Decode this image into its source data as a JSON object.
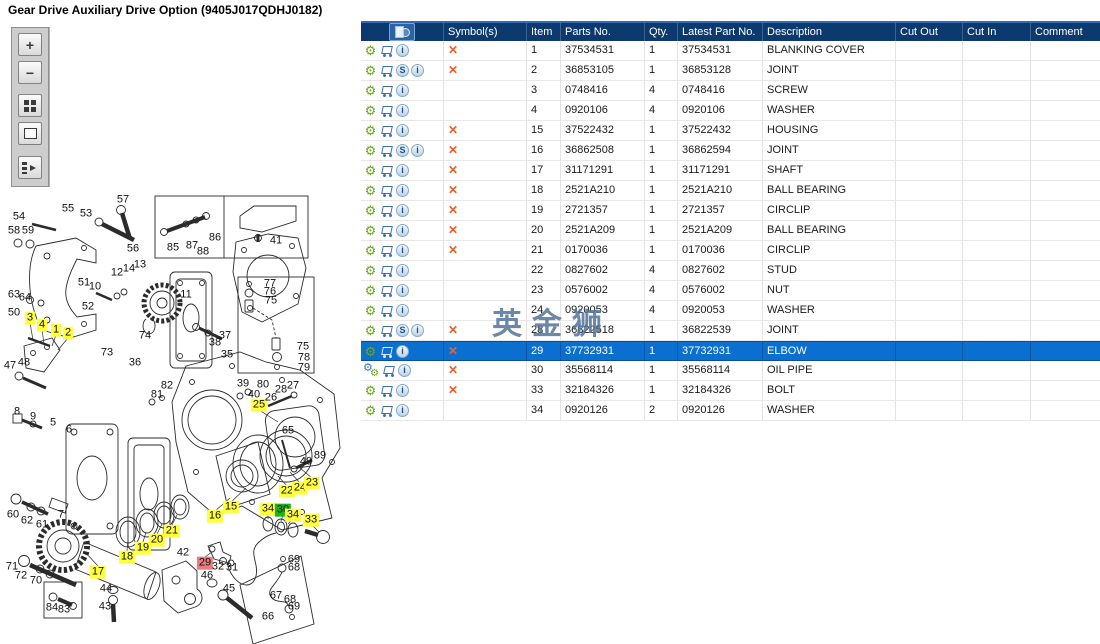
{
  "title": "Gear Drive Auxiliary Drive Option (9405J017QDHJ0182)",
  "watermark": "英金狮",
  "colors": {
    "header_bg": "#0D3A6E",
    "header_text": "#FFFFFF",
    "selected_bg": "#0B6FD0",
    "selected_text": "#FFFFFF",
    "grid_line": "#E3E3E3",
    "cross": "#E8622D",
    "gear_green": "#67A81C",
    "cart_blue": "#3D6EB5",
    "hl_yellow": "#FFFF3F",
    "hl_green": "#1DB31D",
    "hl_red": "#E97C7C",
    "watermark": "#53749B"
  },
  "icons": {
    "gear_glyph": "⚙",
    "cross_glyph": "✕",
    "s_glyph": "S",
    "info_glyph": "i"
  },
  "toolbar": {
    "buttons": [
      {
        "name": "zoom-in",
        "glyph": "+"
      },
      {
        "name": "zoom-out",
        "glyph": "−"
      },
      {
        "name": "tile-view",
        "glyph": ""
      },
      {
        "name": "fit-view",
        "glyph": ""
      },
      {
        "name": "export-panel",
        "glyph": ""
      }
    ]
  },
  "table": {
    "columns": [
      {
        "key": "tools",
        "label": ""
      },
      {
        "key": "symbols",
        "label": "Symbol(s)"
      },
      {
        "key": "item",
        "label": "Item"
      },
      {
        "key": "parts_no",
        "label": "Parts No."
      },
      {
        "key": "qty",
        "label": "Qty."
      },
      {
        "key": "latest_part_no",
        "label": "Latest Part No."
      },
      {
        "key": "description",
        "label": "Description"
      },
      {
        "key": "cut_out",
        "label": "Cut Out"
      },
      {
        "key": "cut_in",
        "label": "Cut In"
      },
      {
        "key": "comment",
        "label": "Comment"
      }
    ],
    "rows": [
      {
        "item": "1",
        "parts_no": "37534531",
        "qty": "1",
        "latest_part_no": "37534531",
        "description": "BLANKING COVER",
        "symbol": true,
        "icons": [
          "gear",
          "cart",
          "info"
        ],
        "selected": false,
        "cut_out": "",
        "cut_in": "",
        "comment": ""
      },
      {
        "item": "2",
        "parts_no": "36853105",
        "qty": "1",
        "latest_part_no": "36853128",
        "description": "JOINT",
        "symbol": true,
        "icons": [
          "gear",
          "cart",
          "s",
          "info"
        ],
        "selected": false,
        "cut_out": "",
        "cut_in": "",
        "comment": ""
      },
      {
        "item": "3",
        "parts_no": "0748416",
        "qty": "4",
        "latest_part_no": "0748416",
        "description": "SCREW",
        "symbol": false,
        "icons": [
          "gear",
          "cart",
          "info"
        ],
        "selected": false,
        "cut_out": "",
        "cut_in": "",
        "comment": ""
      },
      {
        "item": "4",
        "parts_no": "0920106",
        "qty": "4",
        "latest_part_no": "0920106",
        "description": "WASHER",
        "symbol": false,
        "icons": [
          "gear",
          "cart",
          "info"
        ],
        "selected": false,
        "cut_out": "",
        "cut_in": "",
        "comment": ""
      },
      {
        "item": "15",
        "parts_no": "37522432",
        "qty": "1",
        "latest_part_no": "37522432",
        "description": "HOUSING",
        "symbol": true,
        "icons": [
          "gear",
          "cart",
          "info"
        ],
        "selected": false,
        "cut_out": "",
        "cut_in": "",
        "comment": ""
      },
      {
        "item": "16",
        "parts_no": "36862508",
        "qty": "1",
        "latest_part_no": "36862594",
        "description": "JOINT",
        "symbol": true,
        "icons": [
          "gear",
          "cart",
          "s",
          "info"
        ],
        "selected": false,
        "cut_out": "",
        "cut_in": "",
        "comment": ""
      },
      {
        "item": "17",
        "parts_no": "31171291",
        "qty": "1",
        "latest_part_no": "31171291",
        "description": "SHAFT",
        "symbol": true,
        "icons": [
          "gear",
          "cart",
          "info"
        ],
        "selected": false,
        "cut_out": "",
        "cut_in": "",
        "comment": ""
      },
      {
        "item": "18",
        "parts_no": "2521A210",
        "qty": "1",
        "latest_part_no": "2521A210",
        "description": "BALL BEARING",
        "symbol": true,
        "icons": [
          "gear",
          "cart",
          "info"
        ],
        "selected": false,
        "cut_out": "",
        "cut_in": "",
        "comment": ""
      },
      {
        "item": "19",
        "parts_no": "2721357",
        "qty": "1",
        "latest_part_no": "2721357",
        "description": "CIRCLIP",
        "symbol": true,
        "icons": [
          "gear",
          "cart",
          "info"
        ],
        "selected": false,
        "cut_out": "",
        "cut_in": "",
        "comment": ""
      },
      {
        "item": "20",
        "parts_no": "2521A209",
        "qty": "1",
        "latest_part_no": "2521A209",
        "description": "BALL BEARING",
        "symbol": true,
        "icons": [
          "gear",
          "cart",
          "info"
        ],
        "selected": false,
        "cut_out": "",
        "cut_in": "",
        "comment": ""
      },
      {
        "item": "21",
        "parts_no": "0170036",
        "qty": "1",
        "latest_part_no": "0170036",
        "description": "CIRCLIP",
        "symbol": true,
        "icons": [
          "gear",
          "cart",
          "info"
        ],
        "selected": false,
        "cut_out": "",
        "cut_in": "",
        "comment": ""
      },
      {
        "item": "22",
        "parts_no": "0827602",
        "qty": "4",
        "latest_part_no": "0827602",
        "description": "STUD",
        "symbol": false,
        "icons": [
          "gear",
          "cart",
          "info"
        ],
        "selected": false,
        "cut_out": "",
        "cut_in": "",
        "comment": ""
      },
      {
        "item": "23",
        "parts_no": "0576002",
        "qty": "4",
        "latest_part_no": "0576002",
        "description": "NUT",
        "symbol": false,
        "icons": [
          "gear",
          "cart",
          "info"
        ],
        "selected": false,
        "cut_out": "",
        "cut_in": "",
        "comment": ""
      },
      {
        "item": "24",
        "parts_no": "0920053",
        "qty": "4",
        "latest_part_no": "0920053",
        "description": "WASHER",
        "symbol": false,
        "icons": [
          "gear",
          "cart",
          "info"
        ],
        "selected": false,
        "cut_out": "",
        "cut_in": "",
        "comment": ""
      },
      {
        "item": "28",
        "parts_no": "36822518",
        "qty": "1",
        "latest_part_no": "36822539",
        "description": "JOINT",
        "symbol": true,
        "icons": [
          "gear",
          "cart",
          "s",
          "info"
        ],
        "selected": false,
        "cut_out": "",
        "cut_in": "",
        "comment": ""
      },
      {
        "item": "29",
        "parts_no": "37732931",
        "qty": "1",
        "latest_part_no": "37732931",
        "description": "ELBOW",
        "symbol": true,
        "icons": [
          "gear",
          "cart",
          "info"
        ],
        "selected": true,
        "cut_out": "",
        "cut_in": "",
        "comment": ""
      },
      {
        "item": "30",
        "parts_no": "35568114",
        "qty": "1",
        "latest_part_no": "35568114",
        "description": "OIL PIPE",
        "symbol": true,
        "icons": [
          "gear-double",
          "cart",
          "info"
        ],
        "selected": false,
        "cut_out": "",
        "cut_in": "",
        "comment": ""
      },
      {
        "item": "33",
        "parts_no": "32184326",
        "qty": "1",
        "latest_part_no": "32184326",
        "description": "BOLT",
        "symbol": true,
        "icons": [
          "gear",
          "cart",
          "info"
        ],
        "selected": false,
        "cut_out": "",
        "cut_in": "",
        "comment": ""
      },
      {
        "item": "34",
        "parts_no": "0920126",
        "qty": "2",
        "latest_part_no": "0920126",
        "description": "WASHER",
        "symbol": false,
        "icons": [
          "gear",
          "cart",
          "info"
        ],
        "selected": false,
        "cut_out": "",
        "cut_in": "",
        "comment": ""
      }
    ]
  },
  "diagram": {
    "labels": [
      {
        "n": "54",
        "x": 19,
        "y": 217
      },
      {
        "n": "55",
        "x": 68,
        "y": 209
      },
      {
        "n": "53",
        "x": 86,
        "y": 214
      },
      {
        "n": "57",
        "x": 123,
        "y": 200
      },
      {
        "n": "58",
        "x": 14,
        "y": 231
      },
      {
        "n": "59",
        "x": 28,
        "y": 231
      },
      {
        "n": "56",
        "x": 133,
        "y": 249
      },
      {
        "n": "85",
        "x": 173,
        "y": 248
      },
      {
        "n": "87",
        "x": 192,
        "y": 246
      },
      {
        "n": "88",
        "x": 203,
        "y": 252
      },
      {
        "n": "86",
        "x": 215,
        "y": 238
      },
      {
        "n": "41",
        "x": 276,
        "y": 241
      },
      {
        "n": "12",
        "x": 117,
        "y": 273
      },
      {
        "n": "14",
        "x": 129,
        "y": 269
      },
      {
        "n": "13",
        "x": 140,
        "y": 265
      },
      {
        "n": "63",
        "x": 14,
        "y": 295
      },
      {
        "n": "64",
        "x": 25,
        "y": 298
      },
      {
        "n": "50",
        "x": 14,
        "y": 313
      },
      {
        "n": "51",
        "x": 84,
        "y": 283
      },
      {
        "n": "10",
        "x": 95,
        "y": 287
      },
      {
        "n": "52",
        "x": 88,
        "y": 307
      },
      {
        "n": "11",
        "x": 186,
        "y": 295
      },
      {
        "n": "74",
        "x": 145,
        "y": 336
      },
      {
        "n": "3",
        "x": 30,
        "y": 318,
        "h": "y"
      },
      {
        "n": "4",
        "x": 42,
        "y": 325,
        "h": "y"
      },
      {
        "n": "1",
        "x": 56,
        "y": 330,
        "h": "y"
      },
      {
        "n": "2",
        "x": 68,
        "y": 333,
        "h": "y"
      },
      {
        "n": "37",
        "x": 225,
        "y": 336
      },
      {
        "n": "38",
        "x": 215,
        "y": 343
      },
      {
        "n": "35",
        "x": 227,
        "y": 355
      },
      {
        "n": "73",
        "x": 107,
        "y": 353
      },
      {
        "n": "36",
        "x": 135,
        "y": 363
      },
      {
        "n": "47",
        "x": 10,
        "y": 366
      },
      {
        "n": "48",
        "x": 24,
        "y": 363
      },
      {
        "n": "77",
        "x": 270,
        "y": 284
      },
      {
        "n": "76",
        "x": 270,
        "y": 292
      },
      {
        "n": "75",
        "x": 271,
        "y": 301
      },
      {
        "n": "75",
        "x": 303,
        "y": 347
      },
      {
        "n": "78",
        "x": 304,
        "y": 358
      },
      {
        "n": "79",
        "x": 304,
        "y": 368
      },
      {
        "n": "82",
        "x": 167,
        "y": 386
      },
      {
        "n": "81",
        "x": 157,
        "y": 395
      },
      {
        "n": "39",
        "x": 243,
        "y": 384
      },
      {
        "n": "80",
        "x": 263,
        "y": 385
      },
      {
        "n": "40",
        "x": 254,
        "y": 395
      },
      {
        "n": "25",
        "x": 259,
        "y": 405,
        "h": "y"
      },
      {
        "n": "26",
        "x": 271,
        "y": 398
      },
      {
        "n": "28",
        "x": 281,
        "y": 390
      },
      {
        "n": "27",
        "x": 293,
        "y": 386
      },
      {
        "n": "65",
        "x": 288,
        "y": 431
      },
      {
        "n": "8",
        "x": 17,
        "y": 412
      },
      {
        "n": "9",
        "x": 33,
        "y": 417
      },
      {
        "n": "5",
        "x": 53,
        "y": 423
      },
      {
        "n": "6",
        "x": 69,
        "y": 430
      },
      {
        "n": "60",
        "x": 13,
        "y": 515
      },
      {
        "n": "62",
        "x": 27,
        "y": 521
      },
      {
        "n": "61",
        "x": 42,
        "y": 525
      },
      {
        "n": "7",
        "x": 61,
        "y": 515
      },
      {
        "n": "71",
        "x": 12,
        "y": 567
      },
      {
        "n": "72",
        "x": 21,
        "y": 576
      },
      {
        "n": "70",
        "x": 36,
        "y": 581
      },
      {
        "n": "84",
        "x": 52,
        "y": 608
      },
      {
        "n": "83",
        "x": 64,
        "y": 610
      },
      {
        "n": "17",
        "x": 98,
        "y": 572,
        "h": "y"
      },
      {
        "n": "18",
        "x": 127,
        "y": 557,
        "h": "y"
      },
      {
        "n": "19",
        "x": 143,
        "y": 548,
        "h": "y"
      },
      {
        "n": "20",
        "x": 157,
        "y": 540,
        "h": "y"
      },
      {
        "n": "21",
        "x": 172,
        "y": 531,
        "h": "y"
      },
      {
        "n": "42",
        "x": 183,
        "y": 553
      },
      {
        "n": "44",
        "x": 106,
        "y": 589
      },
      {
        "n": "43",
        "x": 105,
        "y": 607
      },
      {
        "n": "49",
        "x": 306,
        "y": 462
      },
      {
        "n": "89",
        "x": 320,
        "y": 456
      },
      {
        "n": "22",
        "x": 287,
        "y": 491,
        "h": "y"
      },
      {
        "n": "24",
        "x": 300,
        "y": 488,
        "h": "y"
      },
      {
        "n": "23",
        "x": 312,
        "y": 483,
        "h": "y"
      },
      {
        "n": "15",
        "x": 231,
        "y": 507,
        "h": "y"
      },
      {
        "n": "16",
        "x": 215,
        "y": 516,
        "h": "y"
      },
      {
        "n": "34",
        "x": 268,
        "y": 509,
        "h": "y"
      },
      {
        "n": "30",
        "x": 283,
        "y": 510,
        "h": "g"
      },
      {
        "n": "34",
        "x": 293,
        "y": 515,
        "h": "y"
      },
      {
        "n": "33",
        "x": 311,
        "y": 520,
        "h": "y"
      },
      {
        "n": "29",
        "x": 205,
        "y": 563,
        "h": "r"
      },
      {
        "n": "32",
        "x": 218,
        "y": 567
      },
      {
        "n": "31",
        "x": 232,
        "y": 568
      },
      {
        "n": "46",
        "x": 207,
        "y": 576
      },
      {
        "n": "45",
        "x": 229,
        "y": 589
      },
      {
        "n": "69",
        "x": 294,
        "y": 560
      },
      {
        "n": "68",
        "x": 294,
        "y": 568
      },
      {
        "n": "67",
        "x": 276,
        "y": 596
      },
      {
        "n": "68",
        "x": 290,
        "y": 600
      },
      {
        "n": "69",
        "x": 294,
        "y": 607
      },
      {
        "n": "66",
        "x": 268,
        "y": 617
      }
    ]
  }
}
